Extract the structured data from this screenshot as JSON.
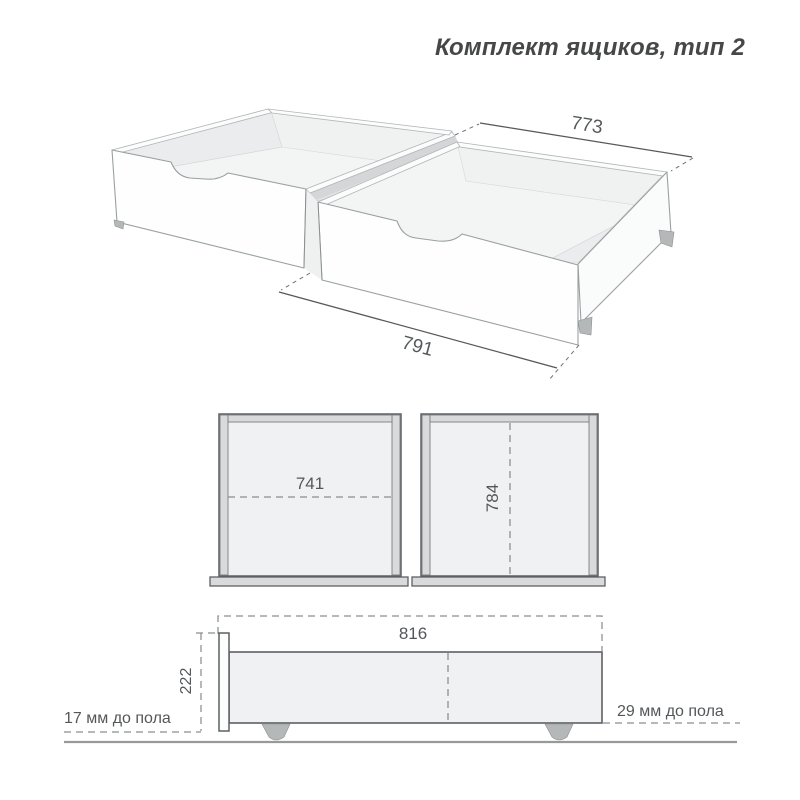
{
  "title": "Комплект ящиков, тип 2",
  "perspective_view": {
    "dim_depth": "773",
    "dim_length": "791"
  },
  "top_view_left": {
    "dim_width": "741"
  },
  "top_view_right": {
    "dim_depth": "784"
  },
  "side_view": {
    "dim_length": "816",
    "dim_height": "222",
    "clearance_left": "17 мм до пола",
    "clearance_right": "29 мм до пола"
  },
  "colors": {
    "title": "#454749",
    "text": "#54575a",
    "line": "#5d6063",
    "dash": "#8a8d8f",
    "edge3d": "#9aa0a1",
    "dim3d": "#56595b",
    "fill-interior": "#f0f1f2",
    "fill-wall": "#d8dadb",
    "fill-wheel": "#b5b8b9",
    "floor": "#97999b"
  }
}
